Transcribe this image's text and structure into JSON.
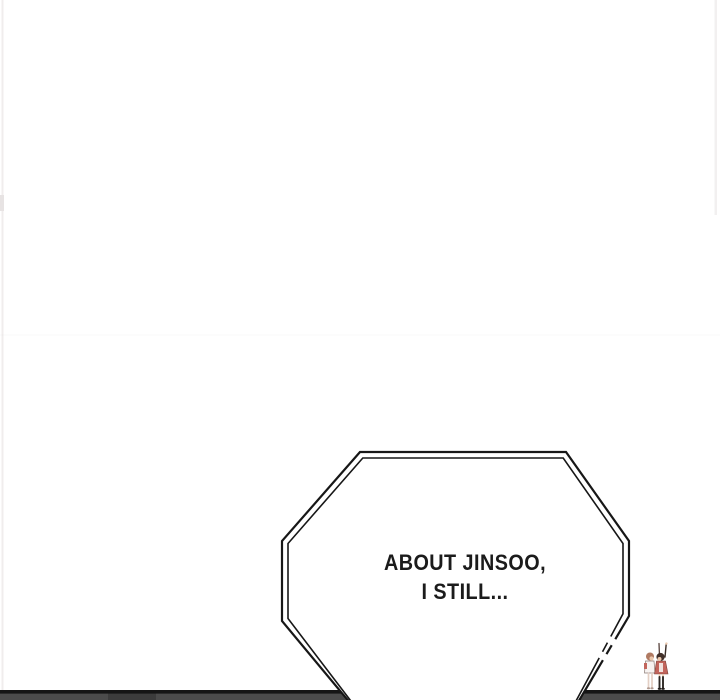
{
  "canvas": {
    "width": 720,
    "height": 700,
    "background_color": "#ffffff"
  },
  "comic": {
    "speech_bubble": {
      "shape": "double-bordered-octagon",
      "text_line_1": "ABOUT JINSOO,",
      "text_line_2": "I STILL...",
      "text_color": "#1b1b1b",
      "border_color": "#171717",
      "fill_color": "#ffffff"
    },
    "panel_divider_bar": {
      "black_line_color": "#151515",
      "gray_fill_color": "#4b4b4b",
      "smudge_color": "#3a3a3a"
    },
    "characters_figure": {
      "icon": "two-chibi-characters",
      "hair_left_color": "#b07a62",
      "hair_right_color": "#42302a",
      "outfit_color": "#c2655c",
      "outfit_left_color": "#f7f3f1",
      "skin_color": "#ecc9ae",
      "stocking_color": "#2d2824",
      "pale_leg_color": "#e3cfc4"
    },
    "edge_artifacts": {
      "left_streak_color": "#f0eded",
      "right_streak_color": "#f2f0f0"
    }
  }
}
